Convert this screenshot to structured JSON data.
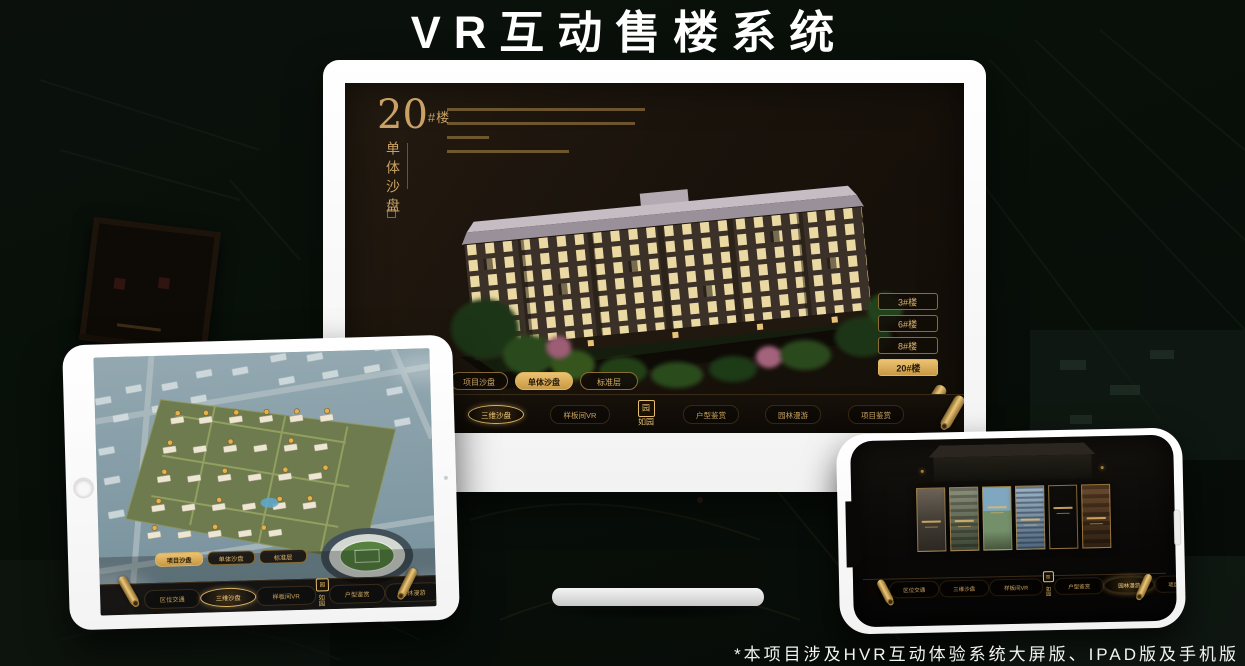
{
  "page": {
    "title": "VR互动售楼系统",
    "footnote": "*本项目涉及HVR互动体验系统大屏版、IPAD版及手机版"
  },
  "colors": {
    "gold": "#c9a165",
    "gold_bright": "#ecc271",
    "screen_bg": "#1a130c",
    "frame_white": "#ffffff"
  },
  "app": {
    "logo": "如园",
    "logo_seal": "园",
    "tabs": [
      "项目沙盘",
      "单体沙盘",
      "标准层"
    ],
    "nav_items": [
      "区位交通",
      "三维沙盘",
      "样板间VR",
      "户型鉴赏",
      "园林漫游",
      "项目鉴赏"
    ]
  },
  "monitor": {
    "title_number": "20",
    "title_suffix": "#楼",
    "subtitle": "单体沙盘",
    "floor_buttons": [
      "3#楼",
      "6#楼",
      "8#楼",
      "20#楼"
    ],
    "active_floor": "20#楼",
    "active_tab": "单体沙盘",
    "active_nav": "三维沙盘"
  },
  "tablet": {
    "active_tab": "项目沙盘",
    "active_nav": "三维沙盘"
  },
  "phone": {
    "active_nav": "园林漫游",
    "panel_count": "6"
  }
}
